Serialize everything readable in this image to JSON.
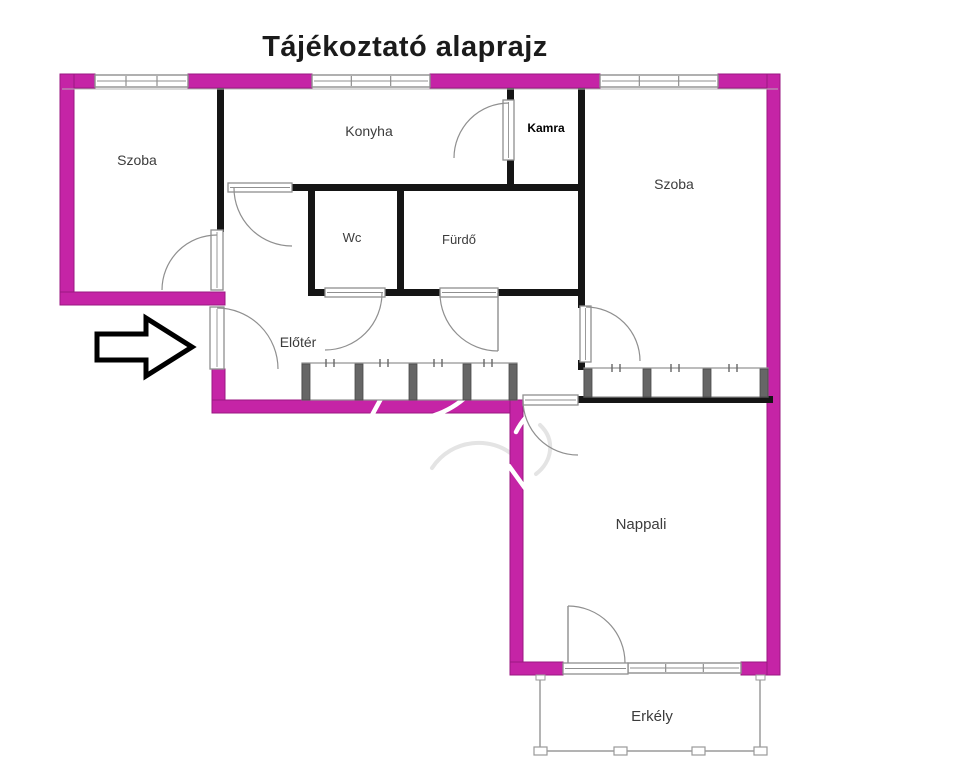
{
  "title": "Tájékoztató alaprajz",
  "rooms": {
    "szoba_left": "Szoba",
    "konyha": "Konyha",
    "kamra": "Kamra",
    "szoba_right": "Szoba",
    "wc": "Wc",
    "furdo": "Fürdő",
    "eloter": "Előtér",
    "nappali": "Nappali",
    "erkely": "Erkély"
  },
  "annotations": {
    "entrance_arrow_icon": "arrow-right-icon"
  },
  "colors": {
    "exterior_wall": "#c524a6",
    "exterior_wall_edge": "#9a1781",
    "interior_wall": "#151515",
    "fixture_outline": "#8f8f8f",
    "fixture_detail": "#666666",
    "plaster_line": "#b5b5b5",
    "label_text": "#3c3c3c",
    "title_text": "#1b1b1b",
    "balcony_line": "#9a9a9a",
    "watermark_white": "#ffffff",
    "watermark_gray": "#e4e4e4"
  }
}
